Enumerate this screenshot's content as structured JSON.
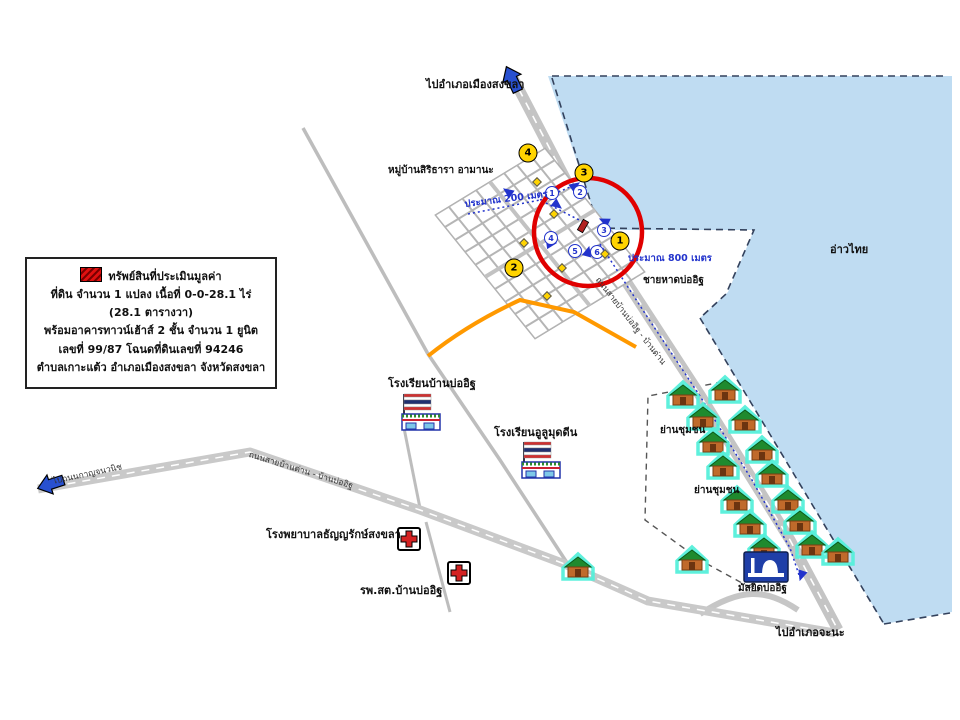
{
  "legend": {
    "title": "ทรัพย์สินที่ประเมินมูลค่า",
    "line2": "ที่ดิน จำนวน 1 แปลง เนื้อที่ 0-0-28.1 ไร่ (28.1 ตารางวา)",
    "line3": "พร้อมอาคารทาวน์เฮ้าส์ 2 ชั้น จำนวน 1 ยูนิต",
    "line4": "เลขที่ 99/87 โฉนดที่ดินเลขที่ 94246",
    "line5": "ตำบลเกาะแต้ว อำเภอเมืองสงขลา จังหวัดสงขลา"
  },
  "labels": {
    "to_city": "ไปอำเภอเมืองสงขลา",
    "village": "หมู่บ้านสิริธารา อามานะ",
    "d200": "ประมาณ 200 เมตร",
    "d800": "ประมาณ 800 เมตร",
    "beach": "ชายหาดบ่ออิฐ",
    "gulf": "อ่าวไทย",
    "school1": "โรงเรียนบ้านบ่ออิฐ",
    "school2": "โรงเรียนอูลูมุดดีน",
    "hospital1": "โรงพยาบาลธัญญรักษ์สงขลา",
    "health_center": "รพ.สต.บ้านบ่ออิฐ",
    "community1": "ย่านชุมชน",
    "community2": "ย่านชุมชน",
    "mosque": "มัสยิดบ่ออิฐ",
    "to_chana": "ไปอำเภอจะนะ",
    "to_kanchana": "ไปถนนกาญจนวนิช",
    "road_bandan": "ถนนสายบ้านด่าน - บ้านบ่ออิฐ",
    "road_main": "ถนนสายบ้านบ่ออิฐ - บ้านด่าน"
  },
  "colors": {
    "sea": "#BFDCF2",
    "road": "#C6C6C6",
    "orange_road": "#FF9900",
    "highlight_circle": "#E00000",
    "marker_yellow": "#FFD400",
    "route_blue": "#2233CC"
  },
  "map": {
    "houses": [
      {
        "x": 683,
        "y": 395
      },
      {
        "x": 725,
        "y": 390
      },
      {
        "x": 703,
        "y": 417
      },
      {
        "x": 745,
        "y": 420
      },
      {
        "x": 713,
        "y": 442
      },
      {
        "x": 762,
        "y": 450
      },
      {
        "x": 723,
        "y": 466
      },
      {
        "x": 772,
        "y": 474
      },
      {
        "x": 737,
        "y": 500
      },
      {
        "x": 788,
        "y": 500
      },
      {
        "x": 750,
        "y": 524
      },
      {
        "x": 800,
        "y": 521
      },
      {
        "x": 764,
        "y": 548
      },
      {
        "x": 812,
        "y": 545
      },
      {
        "x": 578,
        "y": 567
      },
      {
        "x": 692,
        "y": 560
      },
      {
        "x": 838,
        "y": 552
      }
    ],
    "yellow_markers": [
      {
        "n": "1",
        "x": 620,
        "y": 241
      },
      {
        "n": "2",
        "x": 514,
        "y": 268
      },
      {
        "n": "3",
        "x": 584,
        "y": 173
      },
      {
        "n": "4",
        "x": 528,
        "y": 153
      }
    ],
    "blue_markers": [
      {
        "n": "1",
        "x": 552,
        "y": 193
      },
      {
        "n": "2",
        "x": 580,
        "y": 192
      },
      {
        "n": "3",
        "x": 604,
        "y": 230
      },
      {
        "n": "4",
        "x": 551,
        "y": 238
      },
      {
        "n": "5",
        "x": 575,
        "y": 251
      },
      {
        "n": "6",
        "x": 597,
        "y": 252
      }
    ],
    "yellow_dots": [
      {
        "x": 537,
        "y": 182
      },
      {
        "x": 554,
        "y": 214
      },
      {
        "x": 524,
        "y": 243
      },
      {
        "x": 562,
        "y": 268
      },
      {
        "x": 605,
        "y": 254
      },
      {
        "x": 547,
        "y": 296
      }
    ],
    "route_arrows": [
      {
        "x": 579,
        "y": 183,
        "r": -35
      },
      {
        "x": 504,
        "y": 189,
        "r": 215
      },
      {
        "x": 561,
        "y": 208,
        "r": 38
      },
      {
        "x": 600,
        "y": 219,
        "r": 205
      },
      {
        "x": 556,
        "y": 243,
        "r": -8
      },
      {
        "x": 589,
        "y": 247,
        "r": -75
      },
      {
        "x": 800,
        "y": 580,
        "r": 108
      }
    ]
  }
}
